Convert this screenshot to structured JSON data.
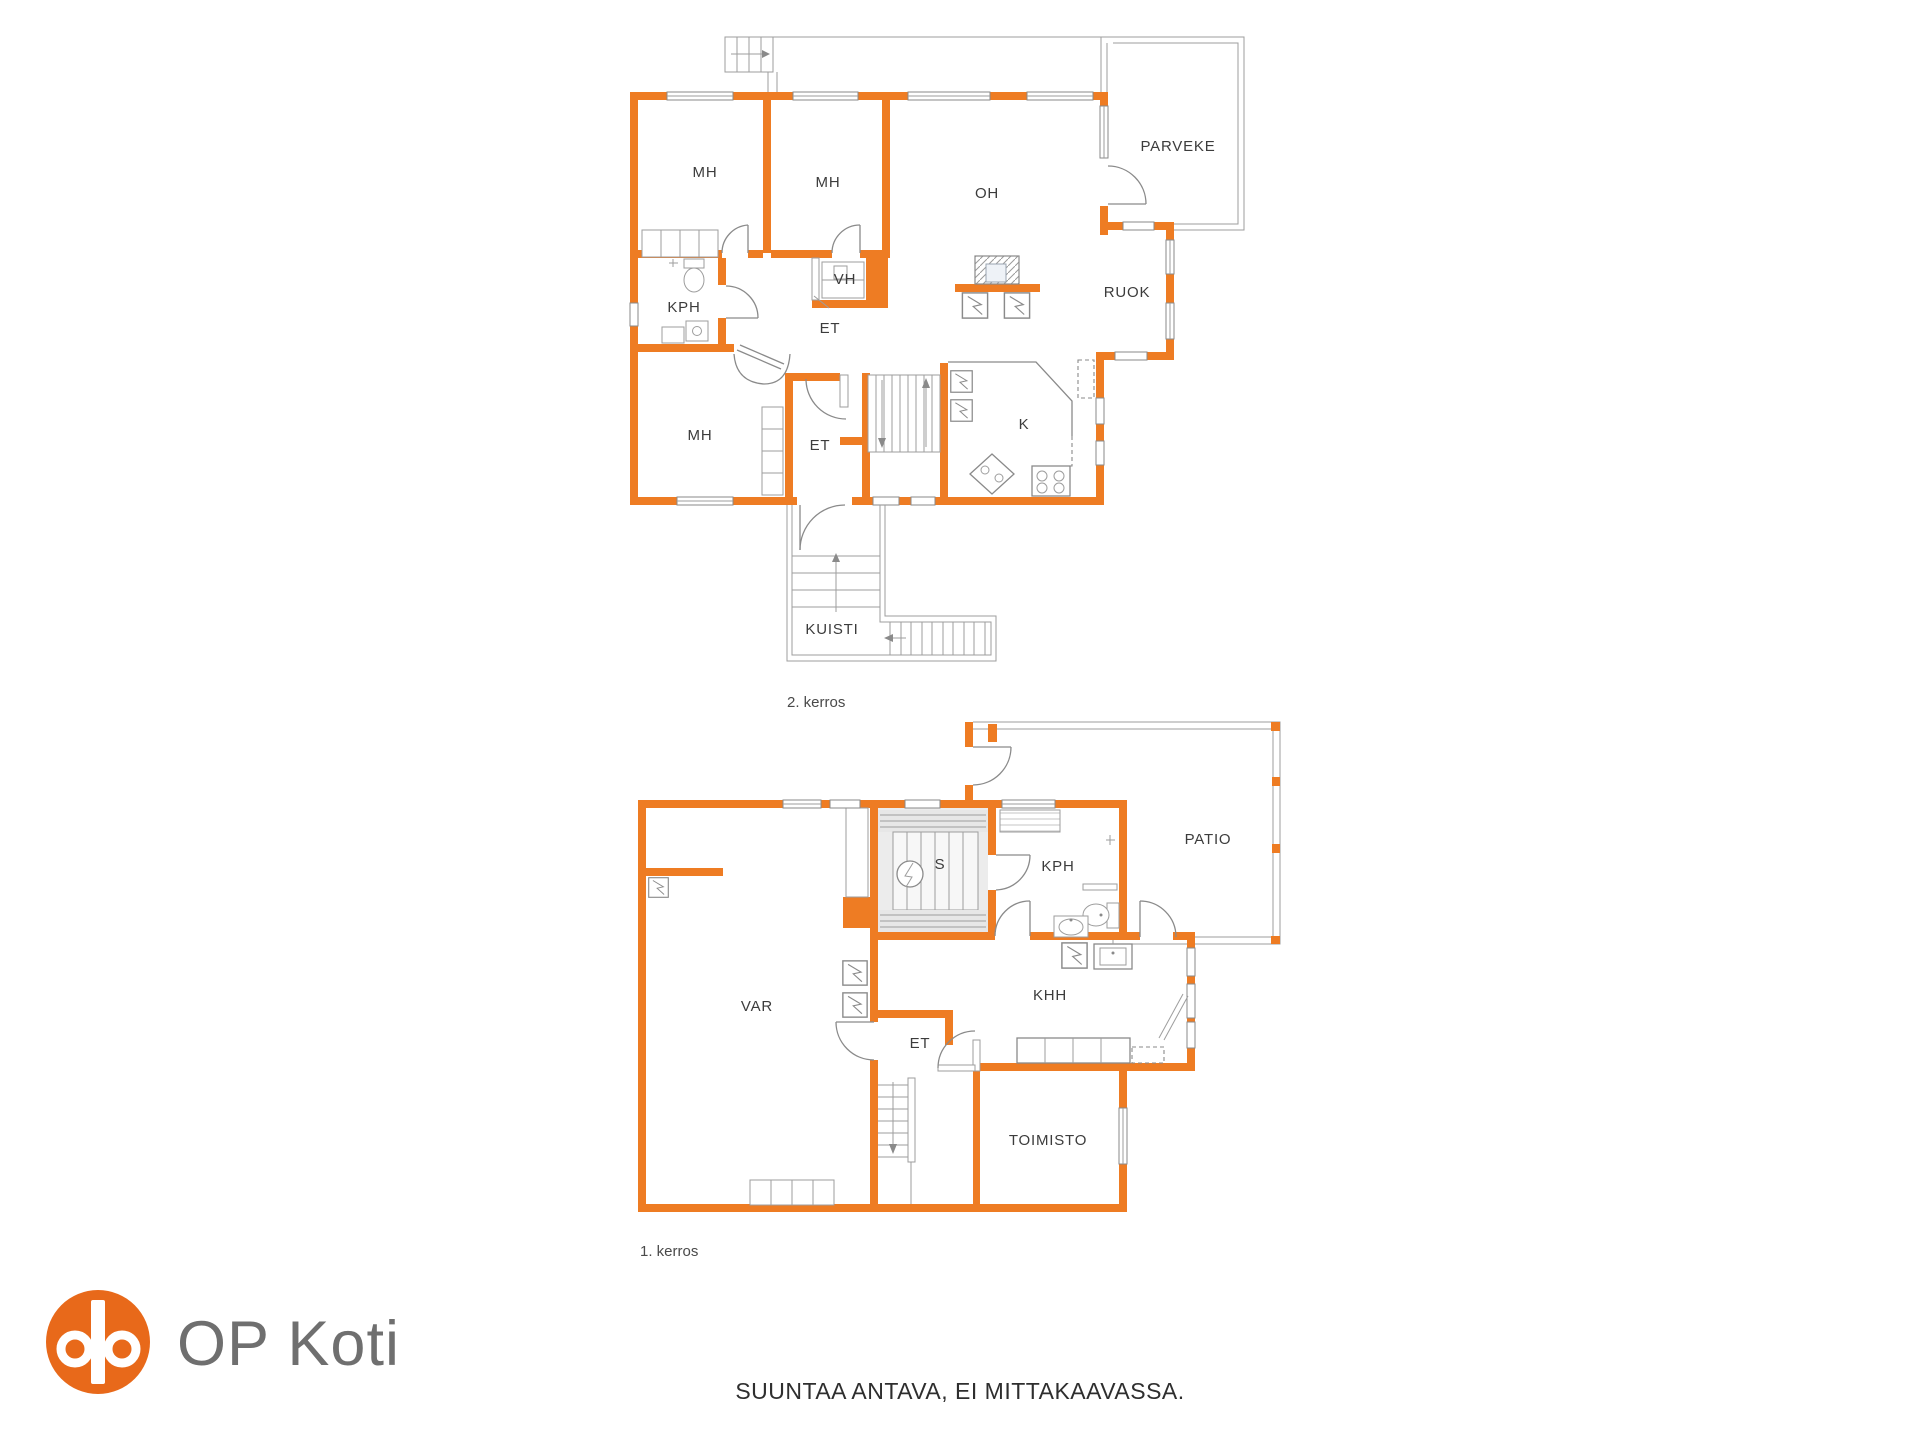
{
  "page": {
    "caption": "SUUNTAA ANTAVA, EI MITTAKAAVASSA.",
    "background": "#ffffff"
  },
  "branding": {
    "logo_text": "OP Koti",
    "logo_color": "#e8691a",
    "logo_text_color": "#6f6f6f",
    "logo_symbol": "op-rings-icon"
  },
  "colors": {
    "wall": "#ee7c23",
    "line": "#8a8a8a",
    "label": "#3c3c3c"
  },
  "floor2": {
    "name": "2. kerros",
    "rooms": [
      {
        "label": "MH"
      },
      {
        "label": "MH"
      },
      {
        "label": "OH"
      },
      {
        "label": "PARVEKE"
      },
      {
        "label": "VH"
      },
      {
        "label": "RUOK"
      },
      {
        "label": "KPH"
      },
      {
        "label": "ET"
      },
      {
        "label": "MH"
      },
      {
        "label": "ET"
      },
      {
        "label": "K"
      },
      {
        "label": "KUISTI"
      }
    ]
  },
  "floor1": {
    "name": "1. kerros",
    "rooms": [
      {
        "label": "S"
      },
      {
        "label": "KPH"
      },
      {
        "label": "PATIO"
      },
      {
        "label": "VAR"
      },
      {
        "label": "KHH"
      },
      {
        "label": "ET"
      },
      {
        "label": "TOIMISTO"
      }
    ]
  }
}
